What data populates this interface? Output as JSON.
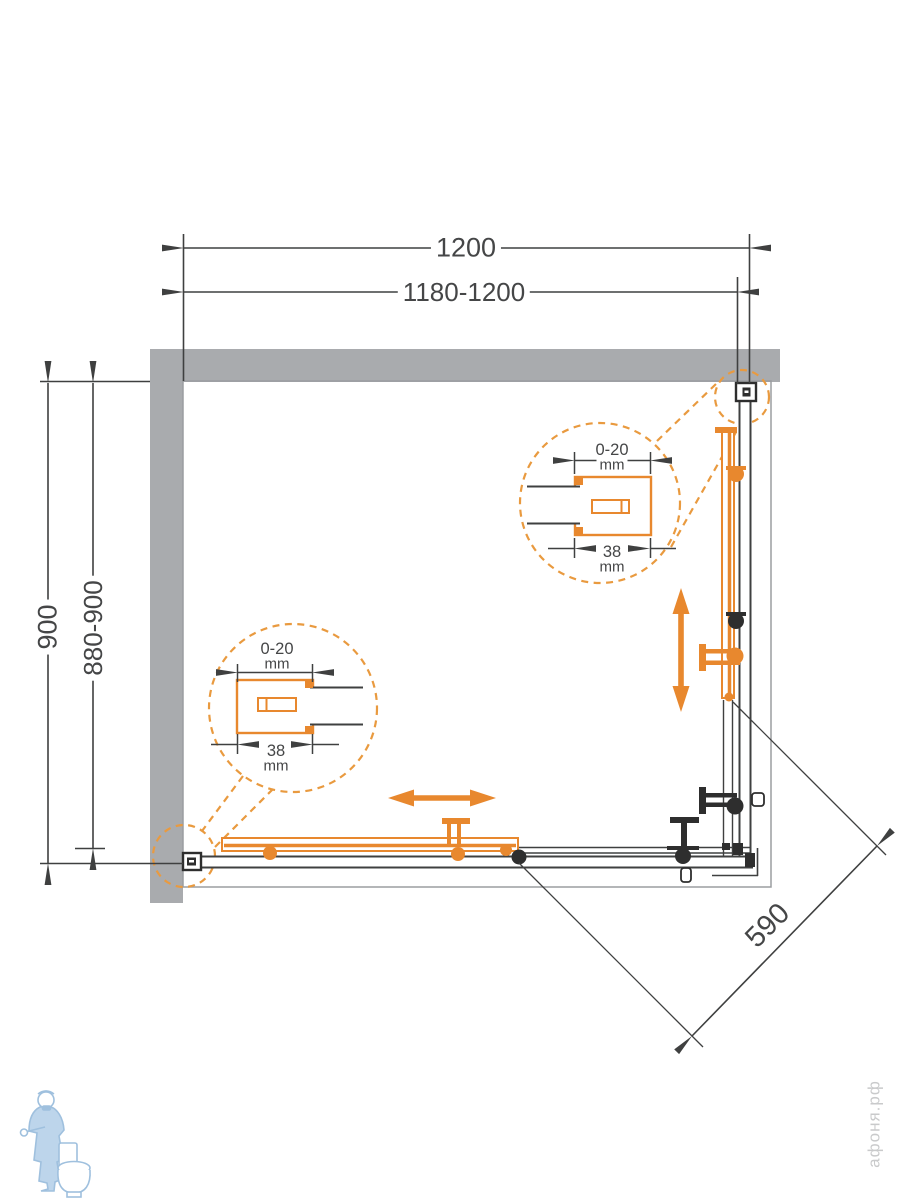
{
  "diagram": {
    "type": "shower-enclosure-plan-view",
    "dims": {
      "width_overall": "1200",
      "width_adjust": "1180-1200",
      "depth_overall": "900",
      "depth_adjust": "880-900",
      "entry_diagonal": "590"
    },
    "detail_left": {
      "adjust_range": "0-20",
      "adjust_unit": "mm",
      "profile_width": "38",
      "profile_unit": "mm"
    },
    "detail_right": {
      "adjust_range": "0-20",
      "adjust_unit": "mm",
      "profile_width": "38",
      "profile_unit": "mm"
    },
    "watermark": {
      "text": "афоня.рф"
    },
    "logo": {
      "name": "plumber-with-toilet-logo"
    },
    "colors": {
      "accent_orange": "#E8882E",
      "dashed_orange": "#E99A3F",
      "wall_gray": "#A9ABAE",
      "line_dark": "#454647",
      "tray_outline": "#9B9DA0",
      "watermark_gray": "#C9CACB",
      "logo_blue": "#9FC0DE"
    }
  }
}
